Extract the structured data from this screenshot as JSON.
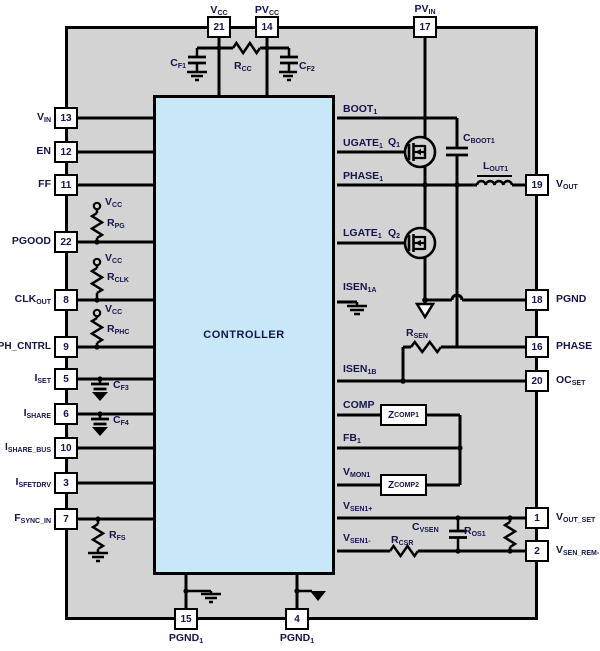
{
  "controller": {
    "label": "CONTROLLER"
  },
  "colors": {
    "board_bg": "#d3d3d3",
    "controller_fill": "#c8e8f8",
    "wire": "#000000",
    "text": "#15154a",
    "pin_fill": "#ffffff"
  },
  "pins": [
    {
      "num": "21",
      "t": "V",
      "s": "CC"
    },
    {
      "num": "14",
      "t": "PV",
      "s": "CC"
    },
    {
      "num": "17",
      "t": "PV",
      "s": "IN"
    },
    {
      "num": "13",
      "t": "V",
      "s": "IN"
    },
    {
      "num": "12",
      "t": "EN",
      "s": ""
    },
    {
      "num": "11",
      "t": "FF",
      "s": ""
    },
    {
      "num": "22",
      "t": "PGOOD",
      "s": ""
    },
    {
      "num": "8",
      "t": "CLK",
      "s": "OUT"
    },
    {
      "num": "9",
      "t": "PH_CNTRL",
      "s": ""
    },
    {
      "num": "5",
      "t": "I",
      "s": "SET"
    },
    {
      "num": "6",
      "t": "I",
      "s": "SHARE"
    },
    {
      "num": "10",
      "t": "I",
      "s": "SHARE_BUS"
    },
    {
      "num": "3",
      "t": "I",
      "s": "SFETDRV"
    },
    {
      "num": "7",
      "t": "F",
      "s": "SYNC_IN"
    },
    {
      "num": "19",
      "t": "V",
      "s": "OUT"
    },
    {
      "num": "18",
      "t": "PGND",
      "s": ""
    },
    {
      "num": "16",
      "t": "PHASE",
      "s": ""
    },
    {
      "num": "20",
      "t": "OC",
      "s": "SET"
    },
    {
      "num": "1",
      "t": "V",
      "s": "OUT_SET"
    },
    {
      "num": "2",
      "t": "V",
      "s": "SEN_REM-"
    },
    {
      "num": "15",
      "t": "PGND",
      "s": "1"
    },
    {
      "num": "4",
      "t": "PGND",
      "s": "1"
    }
  ],
  "ctrl_pins": [
    {
      "t": "BOOT",
      "s": "1"
    },
    {
      "t": "UGATE",
      "s": "1"
    },
    {
      "t": "PHASE",
      "s": "1"
    },
    {
      "t": "LGATE",
      "s": "1"
    },
    {
      "t": "ISEN",
      "s": "1A"
    },
    {
      "t": "ISEN",
      "s": "1B"
    },
    {
      "t": "COMP",
      "s": ""
    },
    {
      "t": "FB",
      "s": "1"
    },
    {
      "t": "V",
      "s": "MON1"
    },
    {
      "t": "V",
      "s": "SEN1+"
    },
    {
      "t": "V",
      "s": "SEN1-"
    }
  ],
  "parts": {
    "cf1": {
      "t": "C",
      "s": "F1"
    },
    "rcc": {
      "t": "R",
      "s": "CC"
    },
    "cf2": {
      "t": "C",
      "s": "F2"
    },
    "q1": {
      "t": "Q",
      "s": "1"
    },
    "q2": {
      "t": "Q",
      "s": "2"
    },
    "cboot1": {
      "t": "C",
      "s": "BOOT1"
    },
    "lout1": {
      "t": "L",
      "s": "OUT1"
    },
    "rsen": {
      "t": "R",
      "s": "SEN"
    },
    "zcomp1": {
      "t": "Z",
      "s": "COMP1"
    },
    "zcomp2": {
      "t": "Z",
      "s": "COMP2"
    },
    "cvsen": {
      "t": "C",
      "s": "VSEN"
    },
    "ros1": {
      "t": "R",
      "s": "OS1"
    },
    "rcsr": {
      "t": "R",
      "s": "CSR"
    },
    "vcc": {
      "t": "V",
      "s": "CC"
    },
    "rpg": {
      "t": "R",
      "s": "PG"
    },
    "rclk": {
      "t": "R",
      "s": "CLK"
    },
    "rphc": {
      "t": "R",
      "s": "PHC"
    },
    "cf3": {
      "t": "C",
      "s": "F3"
    },
    "cf4": {
      "t": "C",
      "s": "F4"
    },
    "rfs": {
      "t": "R",
      "s": "FS"
    }
  }
}
